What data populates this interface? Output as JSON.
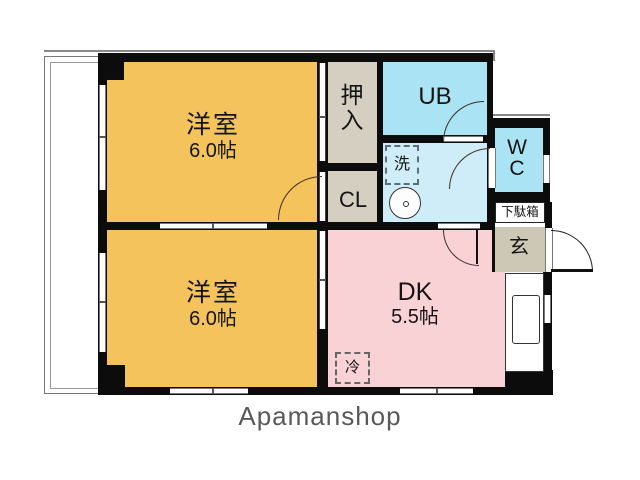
{
  "floorplan": {
    "brand": "Apamanshop",
    "rooms": {
      "bedroom_top": {
        "name": "洋室",
        "size": "6.0帖"
      },
      "bedroom_bottom": {
        "name": "洋室",
        "size": "6.0帖"
      },
      "dining_kitchen": {
        "name": "DK",
        "size": "5.5帖"
      },
      "unit_bath": {
        "label": "UB"
      },
      "toilet": {
        "label": "WC",
        "char1": "W",
        "char2": "C"
      },
      "oshiire_closet": {
        "label": "押入",
        "char1": "押",
        "char2": "入"
      },
      "cl_closet": {
        "label": "CL"
      },
      "entrance": {
        "label": "玄"
      },
      "shoe_box": {
        "label": "下駄箱"
      }
    },
    "fixtures": {
      "washing_machine": {
        "label": "洗"
      },
      "refrigerator": {
        "label": "冷"
      }
    },
    "colors": {
      "bedroom": "#F5C35C",
      "dining_kitchen": "#F9D2D6",
      "bath_wc": "#AAE3F4",
      "washroom": "#CFEDF8",
      "closet": "#D5CFC1",
      "entrance": "#CDC7B5",
      "wall": "#0C0C0C",
      "brand_text": "#595959"
    }
  }
}
